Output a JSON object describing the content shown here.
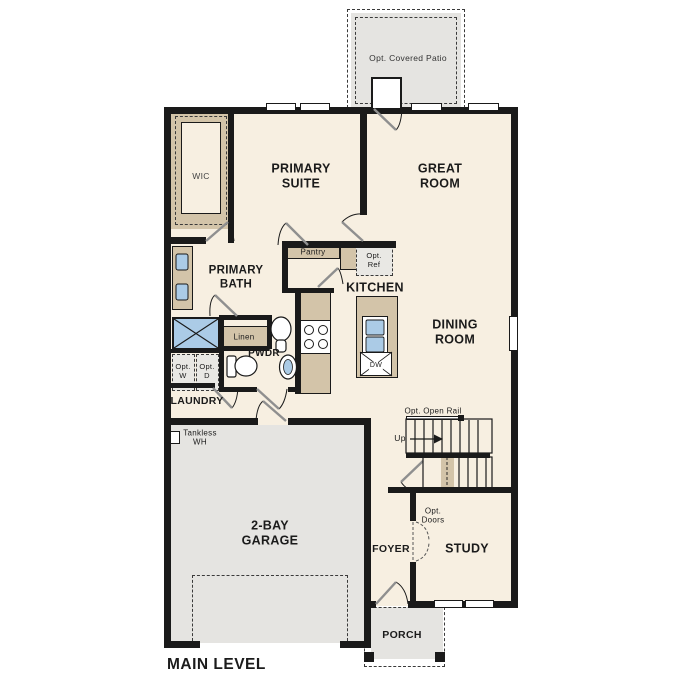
{
  "plan": {
    "title": "MAIN LEVEL",
    "rooms": {
      "wic": "WIC",
      "primary_suite": "PRIMARY SUITE",
      "great_room": "GREAT ROOM",
      "primary_bath": "PRIMARY BATH",
      "kitchen": "KITCHEN",
      "dining_room": "DINING ROOM",
      "pwdr": "PWDR",
      "laundry": "LAUNDRY",
      "garage": "2-BAY GARAGE",
      "foyer": "FOYER",
      "study": "STUDY",
      "porch": "PORCH"
    },
    "features": {
      "opt_covered_patio": "Opt. Covered Patio",
      "pantry": "Pantry",
      "opt_ref": "Opt. Ref",
      "linen": "Linen",
      "opt_w": "Opt. W",
      "opt_d": "Opt. D",
      "tankless_wh": "Tankless WH",
      "opt_open_rail": "Opt. Open Rail",
      "up": "Up",
      "dw": "DW",
      "opt_doors": "Opt. Doors"
    },
    "colors": {
      "floor": "#f7efe1",
      "hard": "#e5e4e1",
      "wall": "#1a1a1a",
      "counter": "#d3c4a9",
      "fixture": "#abcbe6"
    }
  }
}
